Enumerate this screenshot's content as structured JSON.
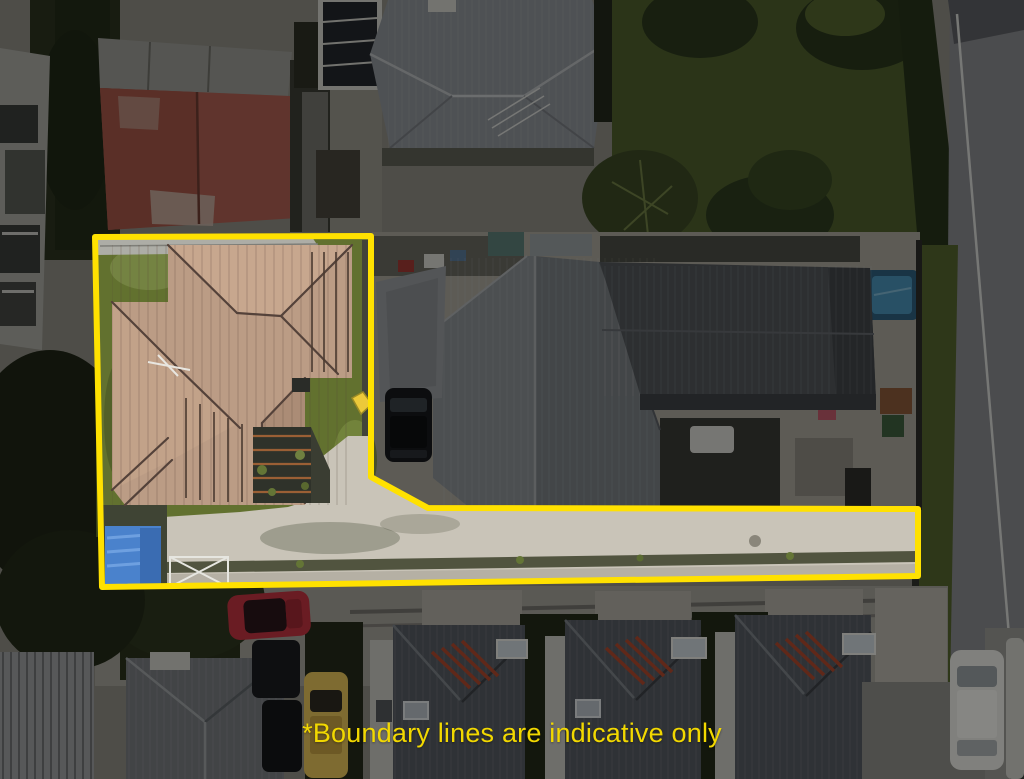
{
  "scene": {
    "type": "aerial-property-photograph",
    "caption": {
      "text": "*Boundary lines are indicative only",
      "color": "#F2D800",
      "font_size_px": 27
    }
  },
  "boundary": {
    "points": "95,237 371,236 371,477 428,508 918,509 918,576 102,587",
    "color": "#FFE100",
    "stroke_width": 6,
    "dim_opacity": 0.45
  },
  "palette": {
    "highlight_yellow": "#FFE100",
    "caption_yellow": "#F2D800",
    "subject_roof_tan": "#BB9C85",
    "subject_grass": "#62712F",
    "driveway_concrete": "#C9C4B8",
    "tarp_blue": "#4A82CC",
    "trampoline_blue": "#4A93B8",
    "road_grey": "#898A8E"
  }
}
